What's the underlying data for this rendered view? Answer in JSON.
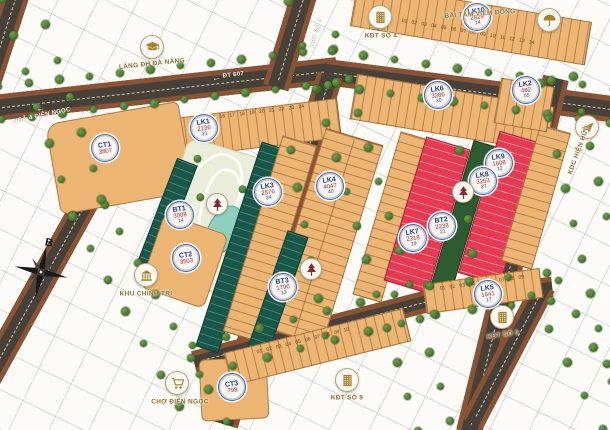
{
  "compass": {
    "label": "B"
  },
  "colors": {
    "road": "#474139",
    "curb": "#8a5334",
    "lot_tan": "#ecb573",
    "lot_red": "#e63a52",
    "villa_green": "#17584a",
    "park": "#e9edda",
    "lake": "#8ed0be",
    "label_blue": "#1f3d8c",
    "label_gold": "#8a6f2e",
    "icon_gold": "#a8802a",
    "park_icon_red": "#8a2a28"
  },
  "landmarks": [
    {
      "id": "lang-dh-da-nang",
      "label": "LÀNG ĐH ĐÀ NẴNG",
      "icon": "graduation-cap-icon",
      "icon_x": 152,
      "icon_y": 47,
      "label_x": 152,
      "label_y": 64,
      "label_rotate": -6
    },
    {
      "id": "kdt-so-4",
      "label": "KĐT SỐ 4",
      "icon": "building-icon",
      "icon_x": 380,
      "icon_y": 17,
      "label_x": 381,
      "label_y": 36,
      "label_rotate": 0
    },
    {
      "id": "bai-tam-vien-dong",
      "label": "BÃI TẮM VIÊM ĐÔNG",
      "icon": "umbrella-icon",
      "icon_x": 549,
      "icon_y": 20,
      "label_x": 480,
      "label_y": 14,
      "label_rotate": -4
    },
    {
      "id": "kdc-hien-huu",
      "label": "KDC HIỆN HỮU",
      "icon": "plane-icon",
      "icon_x": 587,
      "icon_y": 127,
      "label_x": 579,
      "label_y": 150,
      "label_rotate": -70
    },
    {
      "id": "khu-chinh-tri",
      "label": "KHU CHÍNH TRỊ",
      "icon": "government-icon",
      "icon_x": 146,
      "icon_y": 275,
      "label_x": 146,
      "label_y": 294,
      "label_rotate": 0
    },
    {
      "id": "cho-dien-ngoc",
      "label": "CHỢ ĐIỆN NGỌC",
      "icon": "cart-icon",
      "icon_x": 177,
      "icon_y": 383,
      "label_x": 180,
      "label_y": 402,
      "label_rotate": 0
    },
    {
      "id": "kdt-so-9",
      "label": "KĐT SỐ 9",
      "icon": "building-icon",
      "icon_x": 347,
      "icon_y": 380,
      "label_x": 347,
      "label_y": 398,
      "label_rotate": 0
    },
    {
      "id": "kdt-so-5",
      "label": "KĐT SỐ 5",
      "icon": "building-icon",
      "icon_x": 502,
      "icon_y": 317,
      "label_x": 503,
      "label_y": 335,
      "label_rotate": -8
    }
  ],
  "park_icons": [
    {
      "x": 217,
      "y": 204
    },
    {
      "x": 463,
      "y": 192
    },
    {
      "x": 311,
      "y": 269
    }
  ],
  "block_labels": [
    {
      "name": "CT1",
      "area": "3807",
      "count": "",
      "x": 105,
      "y": 148
    },
    {
      "name": "LK1",
      "area": "2136",
      "count": "21",
      "x": 204,
      "y": 128
    },
    {
      "name": "BT1",
      "area": "3008",
      "count": "14",
      "x": 180,
      "y": 215
    },
    {
      "name": "CT2",
      "area": "3503",
      "count": "",
      "x": 186,
      "y": 258
    },
    {
      "name": "LK3",
      "area": "2576",
      "count": "24",
      "x": 268,
      "y": 192
    },
    {
      "name": "LK4",
      "area": "4047",
      "count": "40",
      "x": 330,
      "y": 186
    },
    {
      "name": "BT3",
      "area": "1796",
      "count": "13",
      "x": 283,
      "y": 287
    },
    {
      "name": "CT3",
      "area": "798",
      "count": "",
      "x": 232,
      "y": 387
    },
    {
      "name": "LK10",
      "area": "2829",
      "count": "14",
      "x": 477,
      "y": 17
    },
    {
      "name": "LK6",
      "area": "3286",
      "count": "30",
      "x": 438,
      "y": 95
    },
    {
      "name": "LK2",
      "area": "482",
      "count": "05",
      "x": 526,
      "y": 90
    },
    {
      "name": "LK9",
      "area": "1608",
      "count": "12",
      "x": 499,
      "y": 163
    },
    {
      "name": "LK8",
      "area": "3253",
      "count": "27",
      "x": 483,
      "y": 181
    },
    {
      "name": "BT2",
      "area": "2233",
      "count": "21",
      "x": 442,
      "y": 226
    },
    {
      "name": "LK7",
      "area": "2218",
      "count": "19",
      "x": 413,
      "y": 238
    },
    {
      "name": "LK5",
      "area": "1641",
      "count": "17",
      "x": 488,
      "y": 294
    }
  ],
  "road_labels": [
    {
      "text": "NGÃ 4 ĐIỆN NGỌC",
      "arrow": "←",
      "x": 41,
      "y": 111,
      "rotate": -12,
      "stack": "col"
    },
    {
      "text": "ĐT 607",
      "arrow": "←",
      "x": 228,
      "y": 76,
      "rotate": -7,
      "stack": "row"
    },
    {
      "text": "KĐT SỐ 7",
      "arrow": "",
      "x": 317,
      "y": 33,
      "rotate": -73,
      "stack": "row"
    },
    {
      "text": "",
      "arrow": "↑",
      "x": 306,
      "y": 36,
      "rotate": -15
    },
    {
      "text": "",
      "arrow": "→",
      "x": 545,
      "y": 65,
      "rotate": 8
    },
    {
      "text": "",
      "arrow": "→",
      "x": 471,
      "y": 30,
      "rotate": -4,
      "muted": true
    }
  ],
  "lot_numbers": {
    "top_strip": "01 02 03 04 05 06 07 08 09 10 11 12 13 14",
    "lk1_strip": "14 15 16 17 18 19 20 21 22 23 24",
    "lk5_strip": "01 02 03 04 05 06 07 08 09",
    "ct3_strip": "01 02 03 04 05 06 07 08 09 10"
  }
}
